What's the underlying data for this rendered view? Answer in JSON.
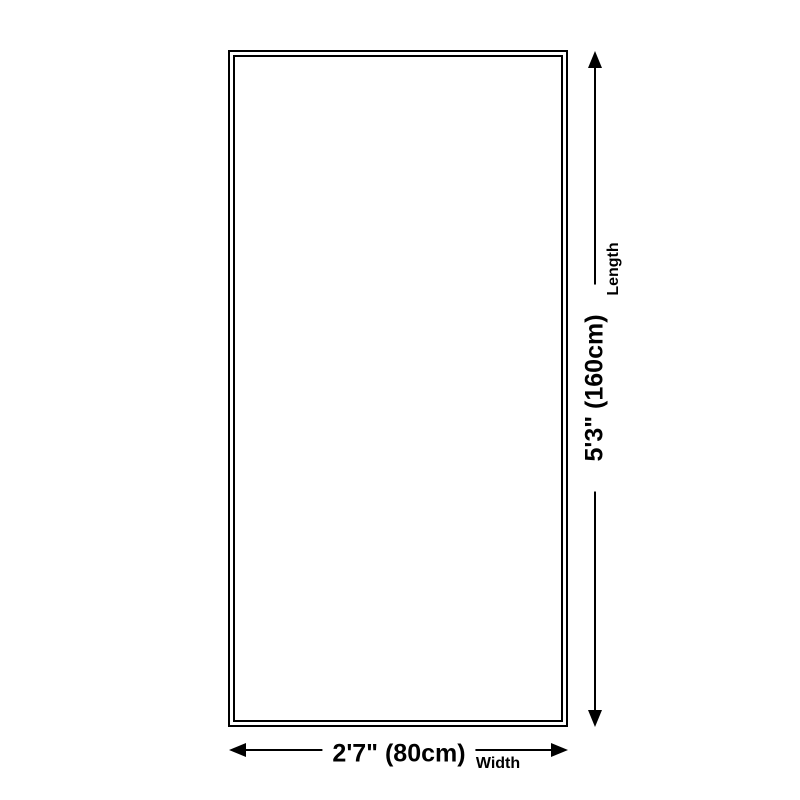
{
  "diagram": {
    "type": "product-dimension-diagram",
    "background_color": "#ffffff",
    "line_color": "#000000",
    "shape": "rectangle-double-border",
    "length_dimension": {
      "value": "5'3\" (160cm)",
      "label": "Length",
      "orientation": "vertical"
    },
    "width_dimension": {
      "value": "2'7\" (80cm)",
      "label": "Width",
      "orientation": "horizontal"
    }
  }
}
